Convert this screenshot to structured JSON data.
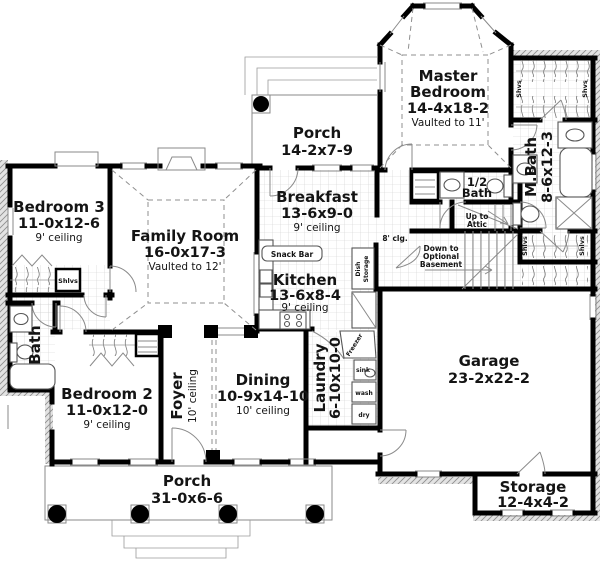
{
  "rooms": {
    "porch_top": {
      "name": "Porch",
      "dims": "14-2x7-9"
    },
    "master_bedroom": {
      "name1": "Master",
      "name2": "Bedroom",
      "dims": "14-4x18-2",
      "note": "Vaulted to 11'"
    },
    "m_bath": {
      "name": "M.Bath",
      "dims": "8-6x12-3"
    },
    "half_bath": {
      "line1": "1/2",
      "line2": "Bath"
    },
    "bedroom3": {
      "name": "Bedroom 3",
      "dims": "11-0x12-6",
      "note": "9' ceiling"
    },
    "family_room": {
      "name": "Family Room",
      "dims": "16-0x17-3",
      "note": "Vaulted to 12'"
    },
    "breakfast": {
      "name": "Breakfast",
      "dims": "13-6x9-0",
      "note": "9' ceiling"
    },
    "kitchen": {
      "name": "Kitchen",
      "dims": "13-6x8-4",
      "note": "9' ceiling"
    },
    "bath": {
      "name": "Bath"
    },
    "bedroom2": {
      "name": "Bedroom 2",
      "dims": "11-0x12-0",
      "note": "9' ceiling"
    },
    "foyer": {
      "name": "Foyer",
      "note": "10' ceiling"
    },
    "dining": {
      "name": "Dining",
      "dims": "10-9x14-10",
      "note": "10' ceiling"
    },
    "laundry": {
      "name": "Laundry",
      "dims": "6-10x10-0"
    },
    "garage": {
      "name": "Garage",
      "dims": "23-2x22-2"
    },
    "porch_bottom": {
      "name": "Porch",
      "dims": "31-0x6-6"
    },
    "storage": {
      "name": "Storage",
      "dims": "12-4x4-2"
    }
  },
  "annotations": {
    "snack_bar": "Snack Bar",
    "dish_line1": "Dish",
    "dish_line2": "Storage",
    "clg8": "8' clg.",
    "attic_line1": "Up to",
    "attic_line2": "Attic",
    "basement_line1": "Down to",
    "basement_line2": "Optional",
    "basement_line3": "Basement",
    "freezer": "Freezer",
    "sink": "sink",
    "wash": "wash",
    "dry": "dry",
    "shlvs": "Shlvs",
    "shvs": "Shvs"
  },
  "colors": {
    "wall": "#000000",
    "fixture": "#555555",
    "tile": "#c9c9c9",
    "hatch": "#9a9a9a",
    "dash": "#8f8f8f",
    "text": "#141414"
  }
}
